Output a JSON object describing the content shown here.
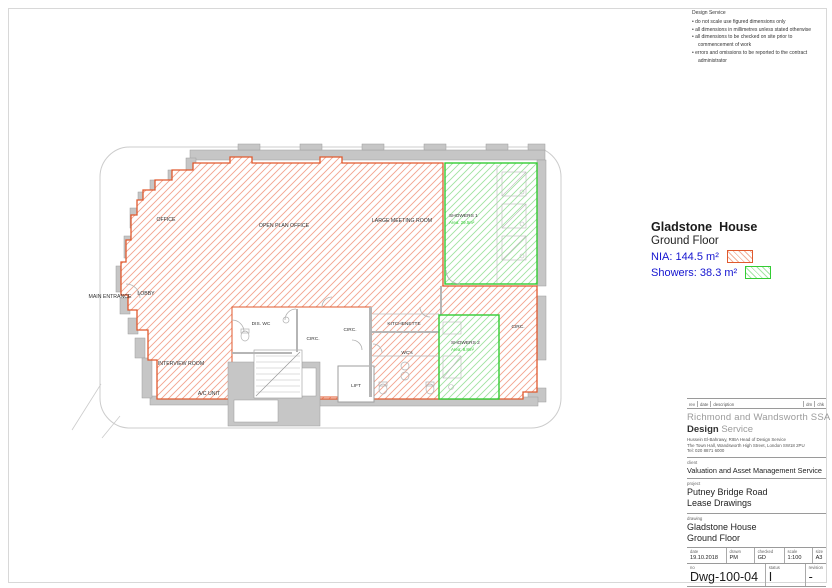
{
  "notes": {
    "title": "Design Service",
    "bullets": [
      "do not scale use figured dimensions only",
      "all dimensions in millimetres unless stated otherwise",
      "all dimensions to be checked on site prior to commencement of work",
      "errors and omissions to be reported to the contract administrator"
    ]
  },
  "legend": {
    "building": "Gladstone  House",
    "floor": "Ground Floor",
    "nia": "NIA: 144.5 m²",
    "showers": "Showers: 38.3 m²",
    "nia_color": "#e0592e",
    "showers_color": "#33cc33",
    "label_color": "#1515d0"
  },
  "plan": {
    "labels": {
      "office": "OFFICE",
      "open_plan": "OPEN PLAN OFFICE",
      "large_meeting": "LARGE MEETING ROOM",
      "main_entrance": "MAIN ENTRANCE",
      "lobby": "LOBBY",
      "interview": "INTERVIEW ROOM",
      "ac_unit": "A/C UNIT",
      "dis_wc": "DIS. WC",
      "circ_core1": "CIRC.",
      "circ_core2": "CIRC.",
      "circ_right": "CIRC.",
      "kitchenette": "KITCHENETTE",
      "wcs": "WC's",
      "lift": "LIFT",
      "showers1_name": "SHOWERS 1",
      "showers1_area": "Area: 29.5m²",
      "showers2_name": "SHOWERS 2",
      "showers2_area": "Area: 8.8m²"
    }
  },
  "titleblock": {
    "rev_header": {
      "rev": "rev",
      "date": "date",
      "description": "description",
      "drn": "drn",
      "chk": "chk"
    },
    "agency_line1": "Richmond and Wandsworth SSA",
    "agency_bold": "Design",
    "agency_light": " Service",
    "address": [
      "Hussein El-Bahrawy, RIBA  Head of Design Service",
      "The Town Hall, Wandsworth High Street, London SW18 2PU",
      "Tel: 020 8871 6000"
    ],
    "client_label": "client",
    "client": "Valuation and Asset Management Service",
    "project_label": "project",
    "project": [
      "Putney Bridge Road",
      "Lease Drawings"
    ],
    "drawing_label": "drawing",
    "drawing": [
      "Gladstone House",
      "Ground Floor"
    ],
    "meta": {
      "date_label": "date",
      "date": "19.10.2018",
      "drawn_label": "drawn",
      "drawn": "PM",
      "checked_label": "checked",
      "checked": "GD",
      "scale_label": "scale",
      "scale": "1:100",
      "size_label": "size",
      "size": "A3"
    },
    "no_label": "no",
    "no": "Dwg-100-04",
    "status_label": "status",
    "status": "I",
    "revision_label": "revision",
    "revision": "-"
  }
}
